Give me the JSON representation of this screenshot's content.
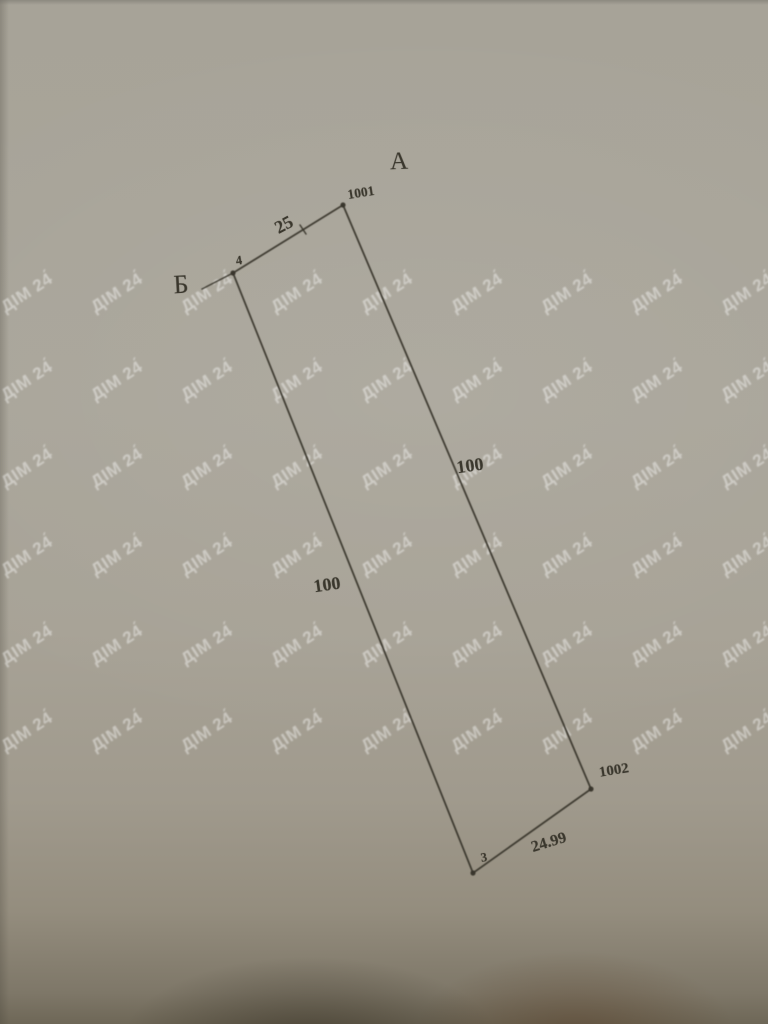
{
  "watermark": {
    "text": "ДІМ 24́",
    "color": "rgba(255,255,255,0.42)",
    "rotation_deg": -33,
    "font_size_px": 17,
    "rows_y": [
      293,
      381,
      468,
      556,
      645,
      732
    ],
    "cols_x": [
      27,
      117,
      207,
      297,
      387,
      477,
      567,
      657,
      747
    ]
  },
  "labels": {
    "region_a": "А",
    "region_b": "Б",
    "point_1001": "1001",
    "point_4": "4",
    "point_3": "3",
    "point_1002": "1002",
    "len_top": "25",
    "len_right": "100",
    "len_left": "100",
    "len_bottom": "24.99"
  },
  "diagram": {
    "ink_color": "#38352b",
    "points": [
      {
        "id": "1001",
        "x": 343,
        "y": 205
      },
      {
        "id": "4",
        "x": 233,
        "y": 273
      },
      {
        "id": "3",
        "x": 473,
        "y": 873
      },
      {
        "id": "1002",
        "x": 591,
        "y": 789
      }
    ],
    "edges": [
      {
        "from": "4",
        "to": "1001",
        "length": "25"
      },
      {
        "from": "1001",
        "to": "1002",
        "length": "100"
      },
      {
        "from": "4",
        "to": "3",
        "length": "100"
      },
      {
        "from": "3",
        "to": "1002",
        "length": "24.99"
      }
    ],
    "extra_segments": [
      {
        "name": "b-leader-line",
        "x1": 202,
        "y1": 289,
        "x2": 233,
        "y2": 273
      },
      {
        "name": "survey-tick",
        "x1": 300,
        "y1": 225,
        "x2": 306,
        "y2": 234
      }
    ]
  }
}
